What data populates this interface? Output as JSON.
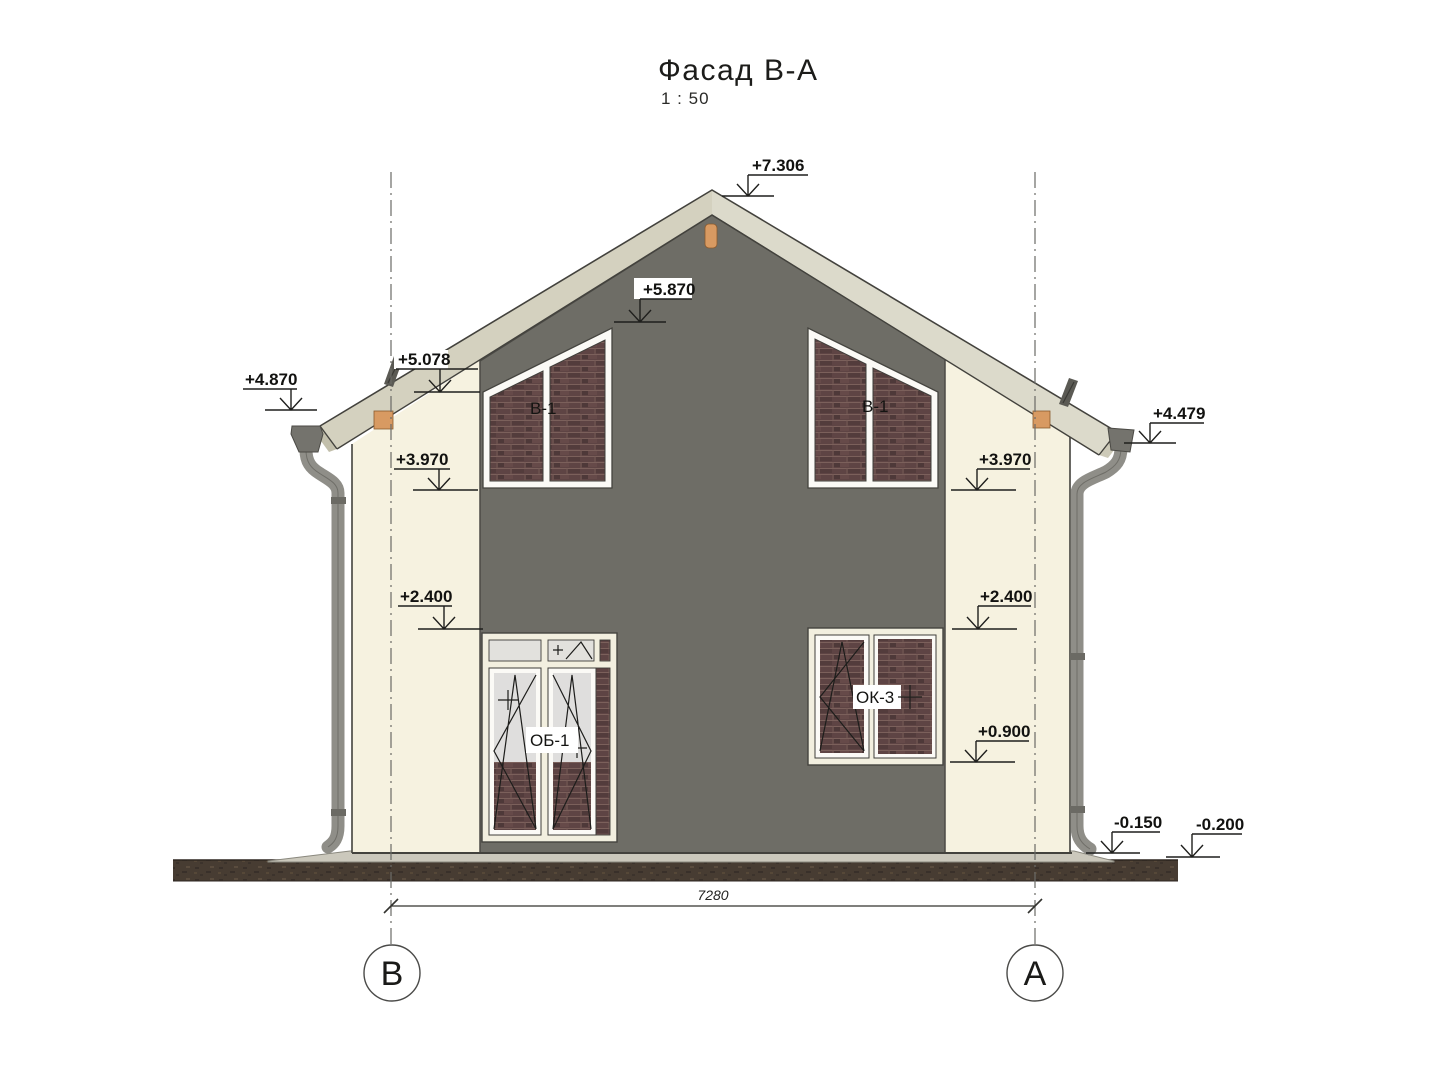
{
  "title": {
    "text": "Фасад В-А",
    "scale": "1 : 50"
  },
  "elevation_marks": [
    {
      "id": "ridge",
      "label": "+7.306"
    },
    {
      "id": "gable-window-head",
      "label": "+5.870"
    },
    {
      "id": "roof-at-axis-b",
      "label": "+5.078"
    },
    {
      "id": "left-eave",
      "label": "+4.870"
    },
    {
      "id": "right-eave",
      "label": "+4.479"
    },
    {
      "id": "gable-sill-left",
      "label": "+3.970"
    },
    {
      "id": "gable-sill-right",
      "label": "+3.970"
    },
    {
      "id": "first-floor-head-left",
      "label": "+2.400"
    },
    {
      "id": "first-floor-head-right",
      "label": "+2.400"
    },
    {
      "id": "window-sill-right",
      "label": "+0.900"
    },
    {
      "id": "blind-area",
      "label": "-0.150"
    },
    {
      "id": "ground-level",
      "label": "-0.200"
    }
  ],
  "window_tags": {
    "gable_left": "В-1",
    "gable_right": "В-1",
    "balcony_door": "ОБ-1",
    "window": "ОК-3"
  },
  "dimension": {
    "overall_width": "7280"
  },
  "axes": {
    "left": "В",
    "right": "А"
  },
  "colors": {
    "wall": "#f6f2e0",
    "panel": "#6e6d66",
    "roof_left": "#d4d1bf",
    "roof_right": "#dcdacb",
    "brick": "#5e4444",
    "ground": "#473c32",
    "blind_area": "#cbc8bc",
    "pipe": "#8f8e88",
    "peg": "#d89a62",
    "glass": "#e7e6e2",
    "frame": "#f2efdf",
    "sash": "#fbfaf6"
  }
}
